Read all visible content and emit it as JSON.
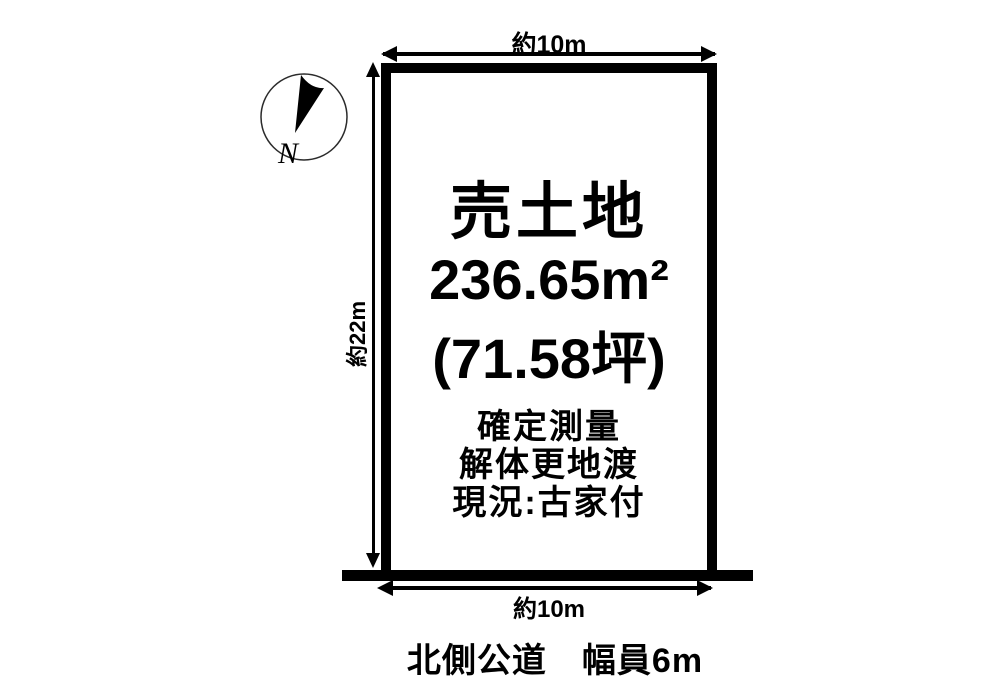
{
  "compass": {
    "label": "N"
  },
  "plot": {
    "title": "売土地",
    "area_m2": "236.65m²",
    "area_tsubo": "(71.58坪)",
    "notes": [
      "確定測量",
      "解体更地渡",
      "現況:古家付"
    ]
  },
  "dimensions": {
    "top": "約10m",
    "left": "約22m",
    "bottom": "約10m"
  },
  "road": {
    "label": "北側公道　幅員6m"
  },
  "colors": {
    "line": "#000000",
    "background": "#ffffff"
  }
}
